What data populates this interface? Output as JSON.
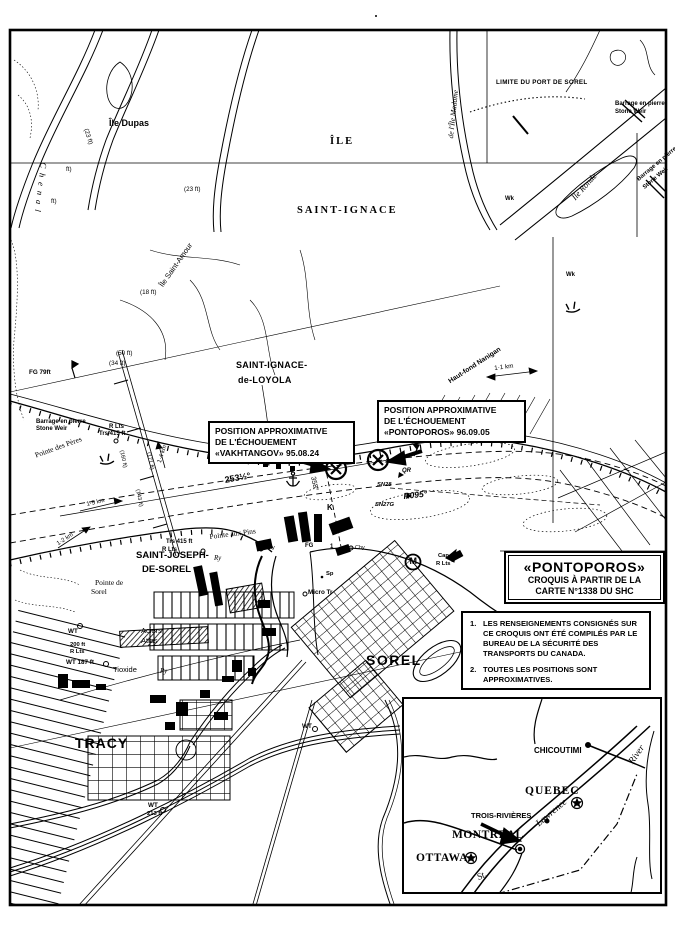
{
  "boxes": {
    "vakhtangov": {
      "line1": "POSITION APPROXIMATIVE",
      "line2": "DE L'ÉCHOUEMENT",
      "line3": "«VAKHTANGOV» 95.08.24"
    },
    "pontoporos": {
      "line1": "POSITION APPROXIMATIVE",
      "line2": "DE L'ÉCHOUEMENT",
      "line3": "«PONTOPOROS» 96.09.05"
    },
    "title": {
      "vessel": "«PONTOPOROS»",
      "line2": "CROQUIS À PARTIR DE LA",
      "line3": "CARTE N°1338 DU SHC"
    },
    "notes": {
      "n1": "1.",
      "t1": "LES RENSEIGNEMENTS CONSIGNÉS SUR CE CROQUIS ONT ÉTÉ COMPILÉS PAR LE BUREAU DE LA SÉCURITÉ DES TRANSPORTS DU CANADA.",
      "n2": "2.",
      "t2": "TOUTES LES POSITIONS SONT APPROXIMATIVES."
    }
  },
  "labels": {
    "ile_dupas": "Île Dupas",
    "ile": "ÎLE",
    "saint_ignace": "SAINT-IGNACE",
    "limite_port": "LIMITE DU PORT DE SOREL",
    "barrage1a": "Barrage en pierre",
    "barrage1b": "Stone Weir",
    "barrage2a": "Barrage en pierre",
    "barrage2b": "Stone Weir",
    "barrage3a": "Barrage en pierre",
    "barrage3b": "Stone Weir",
    "ile_ronde": "Île Ronde",
    "chenal_madame": "de l'Île Madame",
    "chenal": "Chenal",
    "wk1": "Wk",
    "wk2": "Wk",
    "d23a": "(23 ft)",
    "d23b": "(23 ft)",
    "fta": "ft)",
    "ftb": "ft)",
    "ile_st_amour": "Île Saint-Amour",
    "d18": "(18 ft)",
    "d50": "(50 ft)",
    "d34": "(34 ft)",
    "fg79": "FG 79ft",
    "loyola1": "SAINT-IGNACE-",
    "loyola2": "de-LOYOLA",
    "deg2535": "253½°",
    "deg358": "358°",
    "qr": "QR",
    "sn28": "SN28",
    "r095": "R095°",
    "sn27g": "SN27G",
    "k": "K",
    "fg1": "FG",
    "fgnum": "1",
    "chy1": "Chy",
    "chy2": "Chy",
    "pointe_aux_pins": "Pointe aux Pins",
    "sjds1": "SAINT-JOSEPH-",
    "sjds2": "DE-SOREL",
    "pointe_de": "Pointe de",
    "pointe_de2": "Sorel",
    "rlts_n1": "R Lts",
    "rlts_n2": "Trs 415 ft",
    "rlts_s1": "Trs 415 ft",
    "rlts_s2": "R Lts",
    "ry1": "Ry",
    "ry2": "Ry",
    "aciers1": "Aciers",
    "aciers2": "Atlas",
    "wt1": "WT",
    "f200": "200 ft",
    "f200b": "R Lts",
    "wt187": "WT 187 ft",
    "tioxide": "Tioxide",
    "tracy": "TRACY",
    "wt213a": "WT",
    "wt213b": "213 ft",
    "wt_mid": "WT",
    "sorel": "SOREL",
    "micro_tr": "Micro Tr",
    "sp": "Sp",
    "m": "M",
    "cap1": "Cap",
    "cap2": "R Lts",
    "haut_fond": "Haut-fond Nanigan",
    "km11": "1·1 km",
    "km12": "1·2 km",
    "km15": "1·5 km",
    "km14": "1·4 km",
    "ft160": "(160 ft)",
    "ft171": "(171 ft)",
    "ft143": "(143 ft)",
    "pointe_des_peres": "Pointe des Pères"
  },
  "inset": {
    "chicoutimi": "CHICOUTIMI",
    "quebec": "QUEBEC",
    "trois_rivieres": "TROIS-RIVIÈRES",
    "montreal": "MONTREAL",
    "ottawa": "OTTAWA",
    "st": "St.",
    "lawrence": "Lawrence",
    "river": "River"
  }
}
